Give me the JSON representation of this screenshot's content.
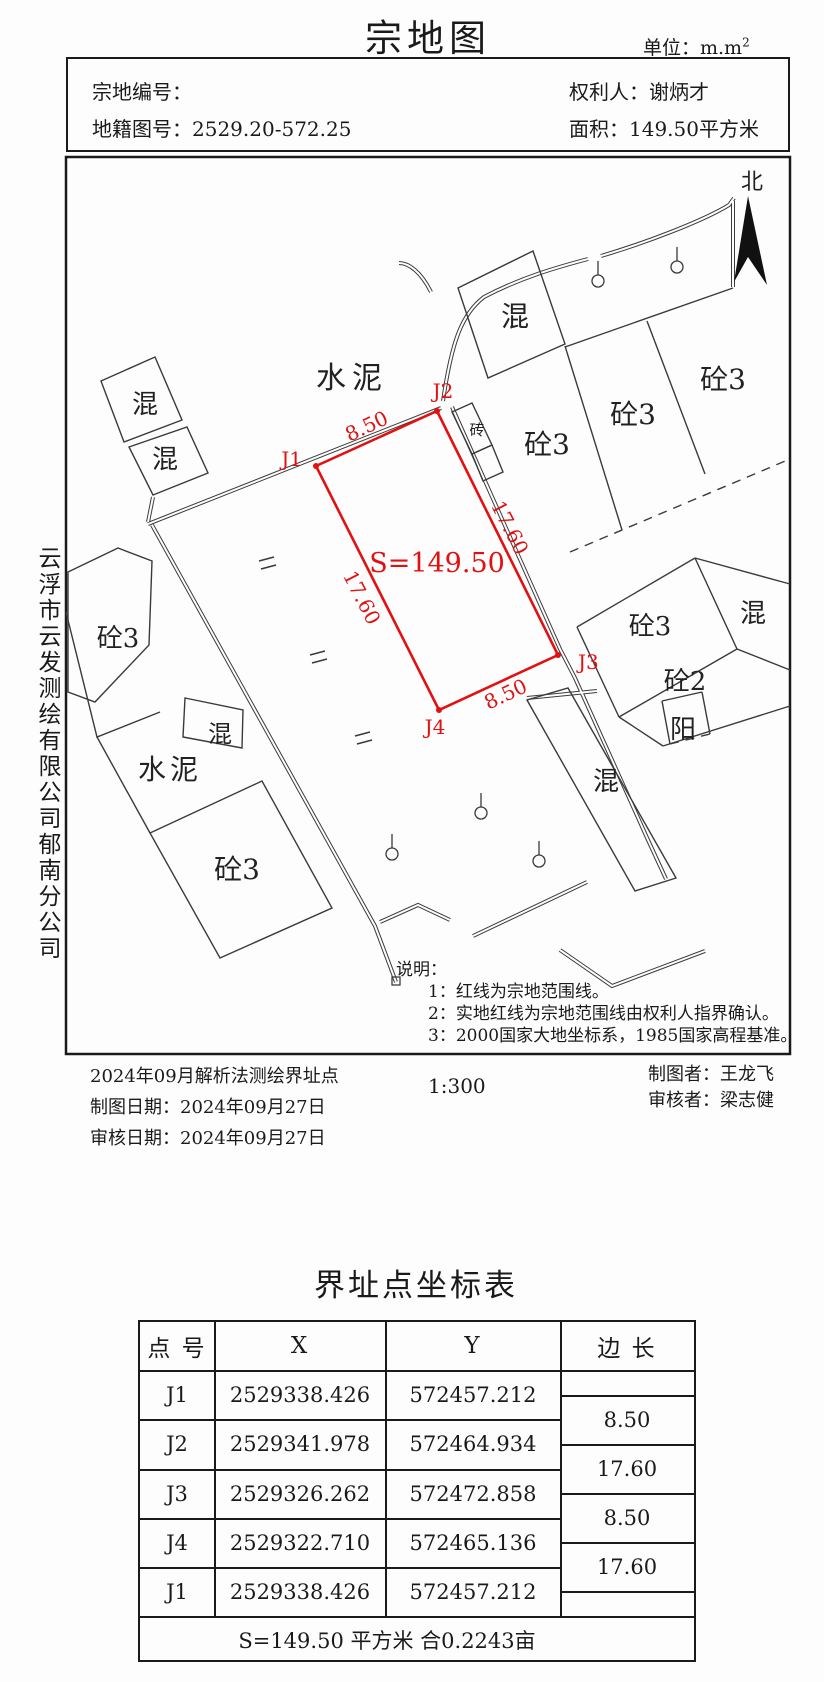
{
  "page": {
    "title": "宗地图",
    "unit_label": "单位：m.m",
    "unit_sup": "2"
  },
  "header": {
    "parcel_no_label": "宗地编号：",
    "parcel_no": "",
    "map_no_label": "地籍图号：",
    "map_no": "2529.20-572.25",
    "owner_label": "权利人：",
    "owner": "谢炳才",
    "area_label": "面积：",
    "area": "149.50平方米"
  },
  "company": {
    "name": "云浮市云发测绘有限公司郁南分公司"
  },
  "map": {
    "north_label": "北",
    "parcel": {
      "area_label": "S=149.50",
      "points": [
        {
          "id": "J1"
        },
        {
          "id": "J2"
        },
        {
          "id": "J3"
        },
        {
          "id": "J4"
        }
      ],
      "edge_labels": [
        "8.50",
        "17.60",
        "17.60",
        "8.50"
      ],
      "red_color": "#e21010"
    },
    "building_labels": [
      {
        "text": "水泥"
      },
      {
        "text": "混"
      },
      {
        "text": "砼3"
      },
      {
        "text": "砼3"
      },
      {
        "text": "砼3"
      },
      {
        "text": "砖"
      },
      {
        "text": "混"
      },
      {
        "text": "混"
      },
      {
        "text": "砼3"
      },
      {
        "text": "混"
      },
      {
        "text": "水泥"
      },
      {
        "text": "砼3"
      },
      {
        "text": "砼3"
      },
      {
        "text": "混"
      },
      {
        "text": "砼2"
      },
      {
        "text": "阳"
      },
      {
        "text": "混"
      }
    ],
    "notes": {
      "title": "说明：",
      "items": [
        "1：红线为宗地范围线。",
        "2：实地红线为宗地范围线由权利人指界确认。",
        "3：2000国家大地坐标系，1985国家高程基准。"
      ]
    }
  },
  "footer": {
    "line1": "2024年09月解析法测绘界址点",
    "line2": "制图日期：2024年09月27日",
    "line3": "审核日期：2024年09月27日",
    "scale": "1:300",
    "drafter": "制图者：王龙飞",
    "reviewer": "审核者：梁志健"
  },
  "table": {
    "title": "界址点坐标表",
    "headers": [
      "点 号",
      "X",
      "Y",
      "边 长"
    ],
    "rows": [
      {
        "id": "J1",
        "x": "2529338.426",
        "y": "572457.212"
      },
      {
        "id": "J2",
        "x": "2529341.978",
        "y": "572464.934"
      },
      {
        "id": "J3",
        "x": "2529326.262",
        "y": "572472.858"
      },
      {
        "id": "J4",
        "x": "2529322.710",
        "y": "572465.136"
      },
      {
        "id": "J1",
        "x": "2529338.426",
        "y": "572457.212"
      }
    ],
    "edges": [
      "8.50",
      "17.60",
      "8.50",
      "17.60"
    ],
    "summary": "S=149.50 平方米 合0.2243亩"
  }
}
